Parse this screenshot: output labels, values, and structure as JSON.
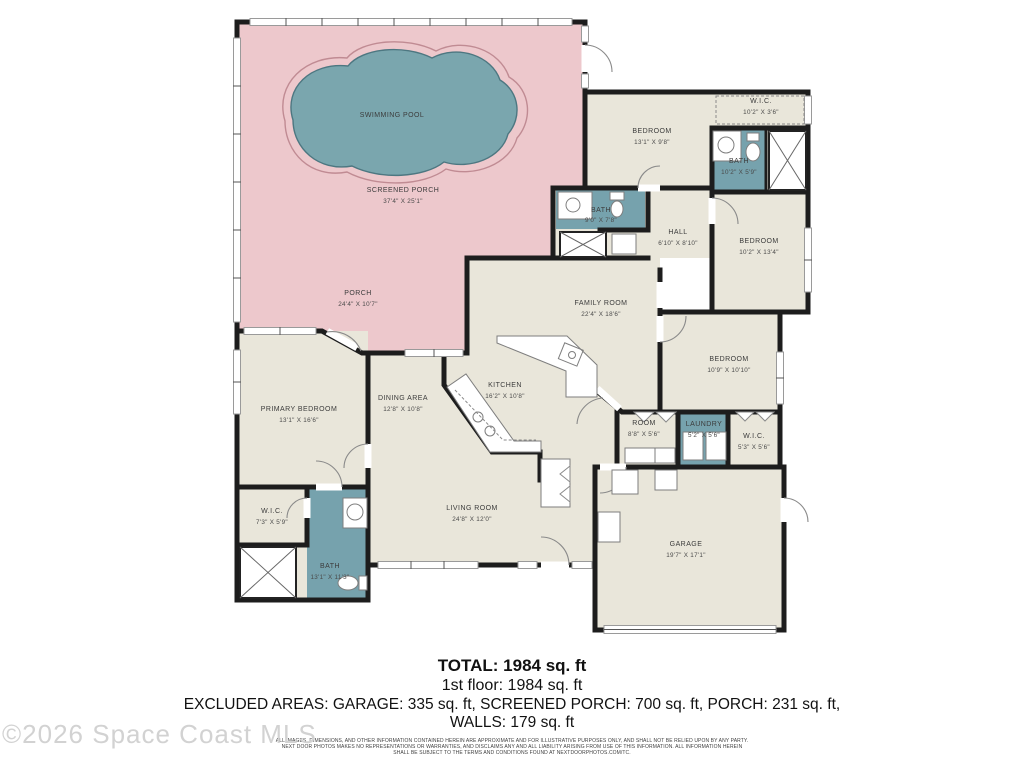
{
  "watermark": "©2026 Space Coast MLS",
  "colors": {
    "porch_pink": "#edc8cc",
    "pool_teal": "#7aa6ae",
    "bath_teal": "#76a2ad",
    "room_beige": "#e9e6da",
    "wall_black": "#1d1d1d"
  },
  "pool": {
    "label": "SWIMMING POOL"
  },
  "rooms": [
    {
      "name": "SCREENED PORCH",
      "dims": "37'4\" X 25'1\""
    },
    {
      "name": "PORCH",
      "dims": "24'4\" X 10'7\""
    },
    {
      "name": "BEDROOM",
      "dims": "13'1\" X 9'8\""
    },
    {
      "name": "W.I.C.",
      "dims": "10'2\" X 3'6\""
    },
    {
      "name": "BATH",
      "dims": "10'2\" X 5'9\""
    },
    {
      "name": "BATH",
      "dims": "9'0\" X 7'8\""
    },
    {
      "name": "HALL",
      "dims": "6'10\" X 8'10\""
    },
    {
      "name": "BEDROOM",
      "dims": "10'2\" X 13'4\""
    },
    {
      "name": "FAMILY ROOM",
      "dims": "22'4\" X 18'6\""
    },
    {
      "name": "BEDROOM",
      "dims": "10'9\" X 10'10\""
    },
    {
      "name": "ROOM",
      "dims": "8'8\" X 5'6\""
    },
    {
      "name": "LAUNDRY",
      "dims": "5'2\" X 5'6\""
    },
    {
      "name": "W.I.C.",
      "dims": "5'3\" X 5'6\""
    },
    {
      "name": "PRIMARY BEDROOM",
      "dims": "13'1\" X 16'6\""
    },
    {
      "name": "DINING AREA",
      "dims": "12'8\" X 10'8\""
    },
    {
      "name": "KITCHEN",
      "dims": "16'2\" X 10'8\""
    },
    {
      "name": "LIVING ROOM",
      "dims": "24'8\" X 12'0\""
    },
    {
      "name": "W.I.C.",
      "dims": "7'3\" X 5'9\""
    },
    {
      "name": "BATH",
      "dims": "13'1\" X 11'3\""
    },
    {
      "name": "GARAGE",
      "dims": "19'7\" X 17'1\""
    }
  ],
  "summary": {
    "total": "TOTAL: 1984 sq. ft",
    "first_floor": "1st floor: 1984 sq. ft",
    "excluded_line1": "EXCLUDED AREAS: GARAGE: 335 sq. ft, SCREENED PORCH: 700 sq. ft, PORCH: 231 sq. ft,",
    "excluded_line2": "WALLS: 179 sq. ft"
  },
  "disclaimer": {
    "line1": "ALL IMAGES, DIMENSIONS, AND OTHER INFORMATION CONTAINED HEREIN ARE APPROXIMATE AND FOR ILLUSTRATIVE PURPOSES ONLY, AND SHALL NOT BE RELIED UPON BY ANY PARTY.",
    "line2": "NEXT DOOR PHOTOS MAKES NO REPRESENTATIONS OR WARRANTIES, AND DISCLAIMS ANY AND ALL LIABILITY ARISING FROM USE OF THIS INFORMATION. ALL INFORMATION HEREIN",
    "line3": "SHALL BE SUBJECT TO THE TERMS AND CONDITIONS FOUND AT NEXTDOORPHOTOS.COM/TC."
  }
}
